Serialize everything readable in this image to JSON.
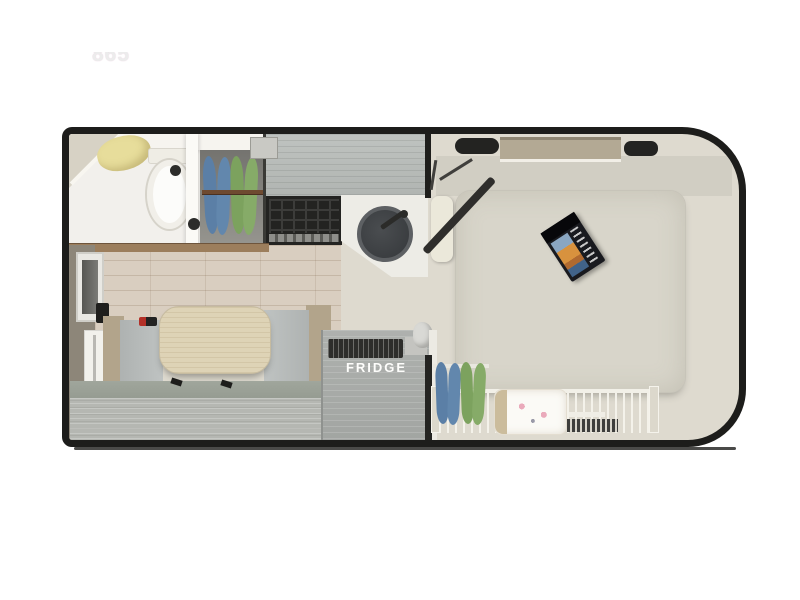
{
  "floorplan": {
    "model_label": "865",
    "labels": {
      "fridge": "FRIDGE"
    },
    "colors": {
      "wall": "#1d1d1b",
      "floor_main": "#dedacf",
      "floor_wood": "#d9cec0",
      "bathroom_white": "#f2f0ec",
      "counter_gray": "#b9bdba",
      "mattress": "#d8d5ca",
      "table_wood": "#ded3b6",
      "bench_gray": "#b8bcbb",
      "fridge_gray": "#a9aca9",
      "hanger_blue": "#5b7fa6",
      "hanger_green": "#7ca25e",
      "towel_yellow": "#e7dd9b",
      "door_dark": "#2f2e2c",
      "nose_window_tan": "#b3a994"
    }
  }
}
